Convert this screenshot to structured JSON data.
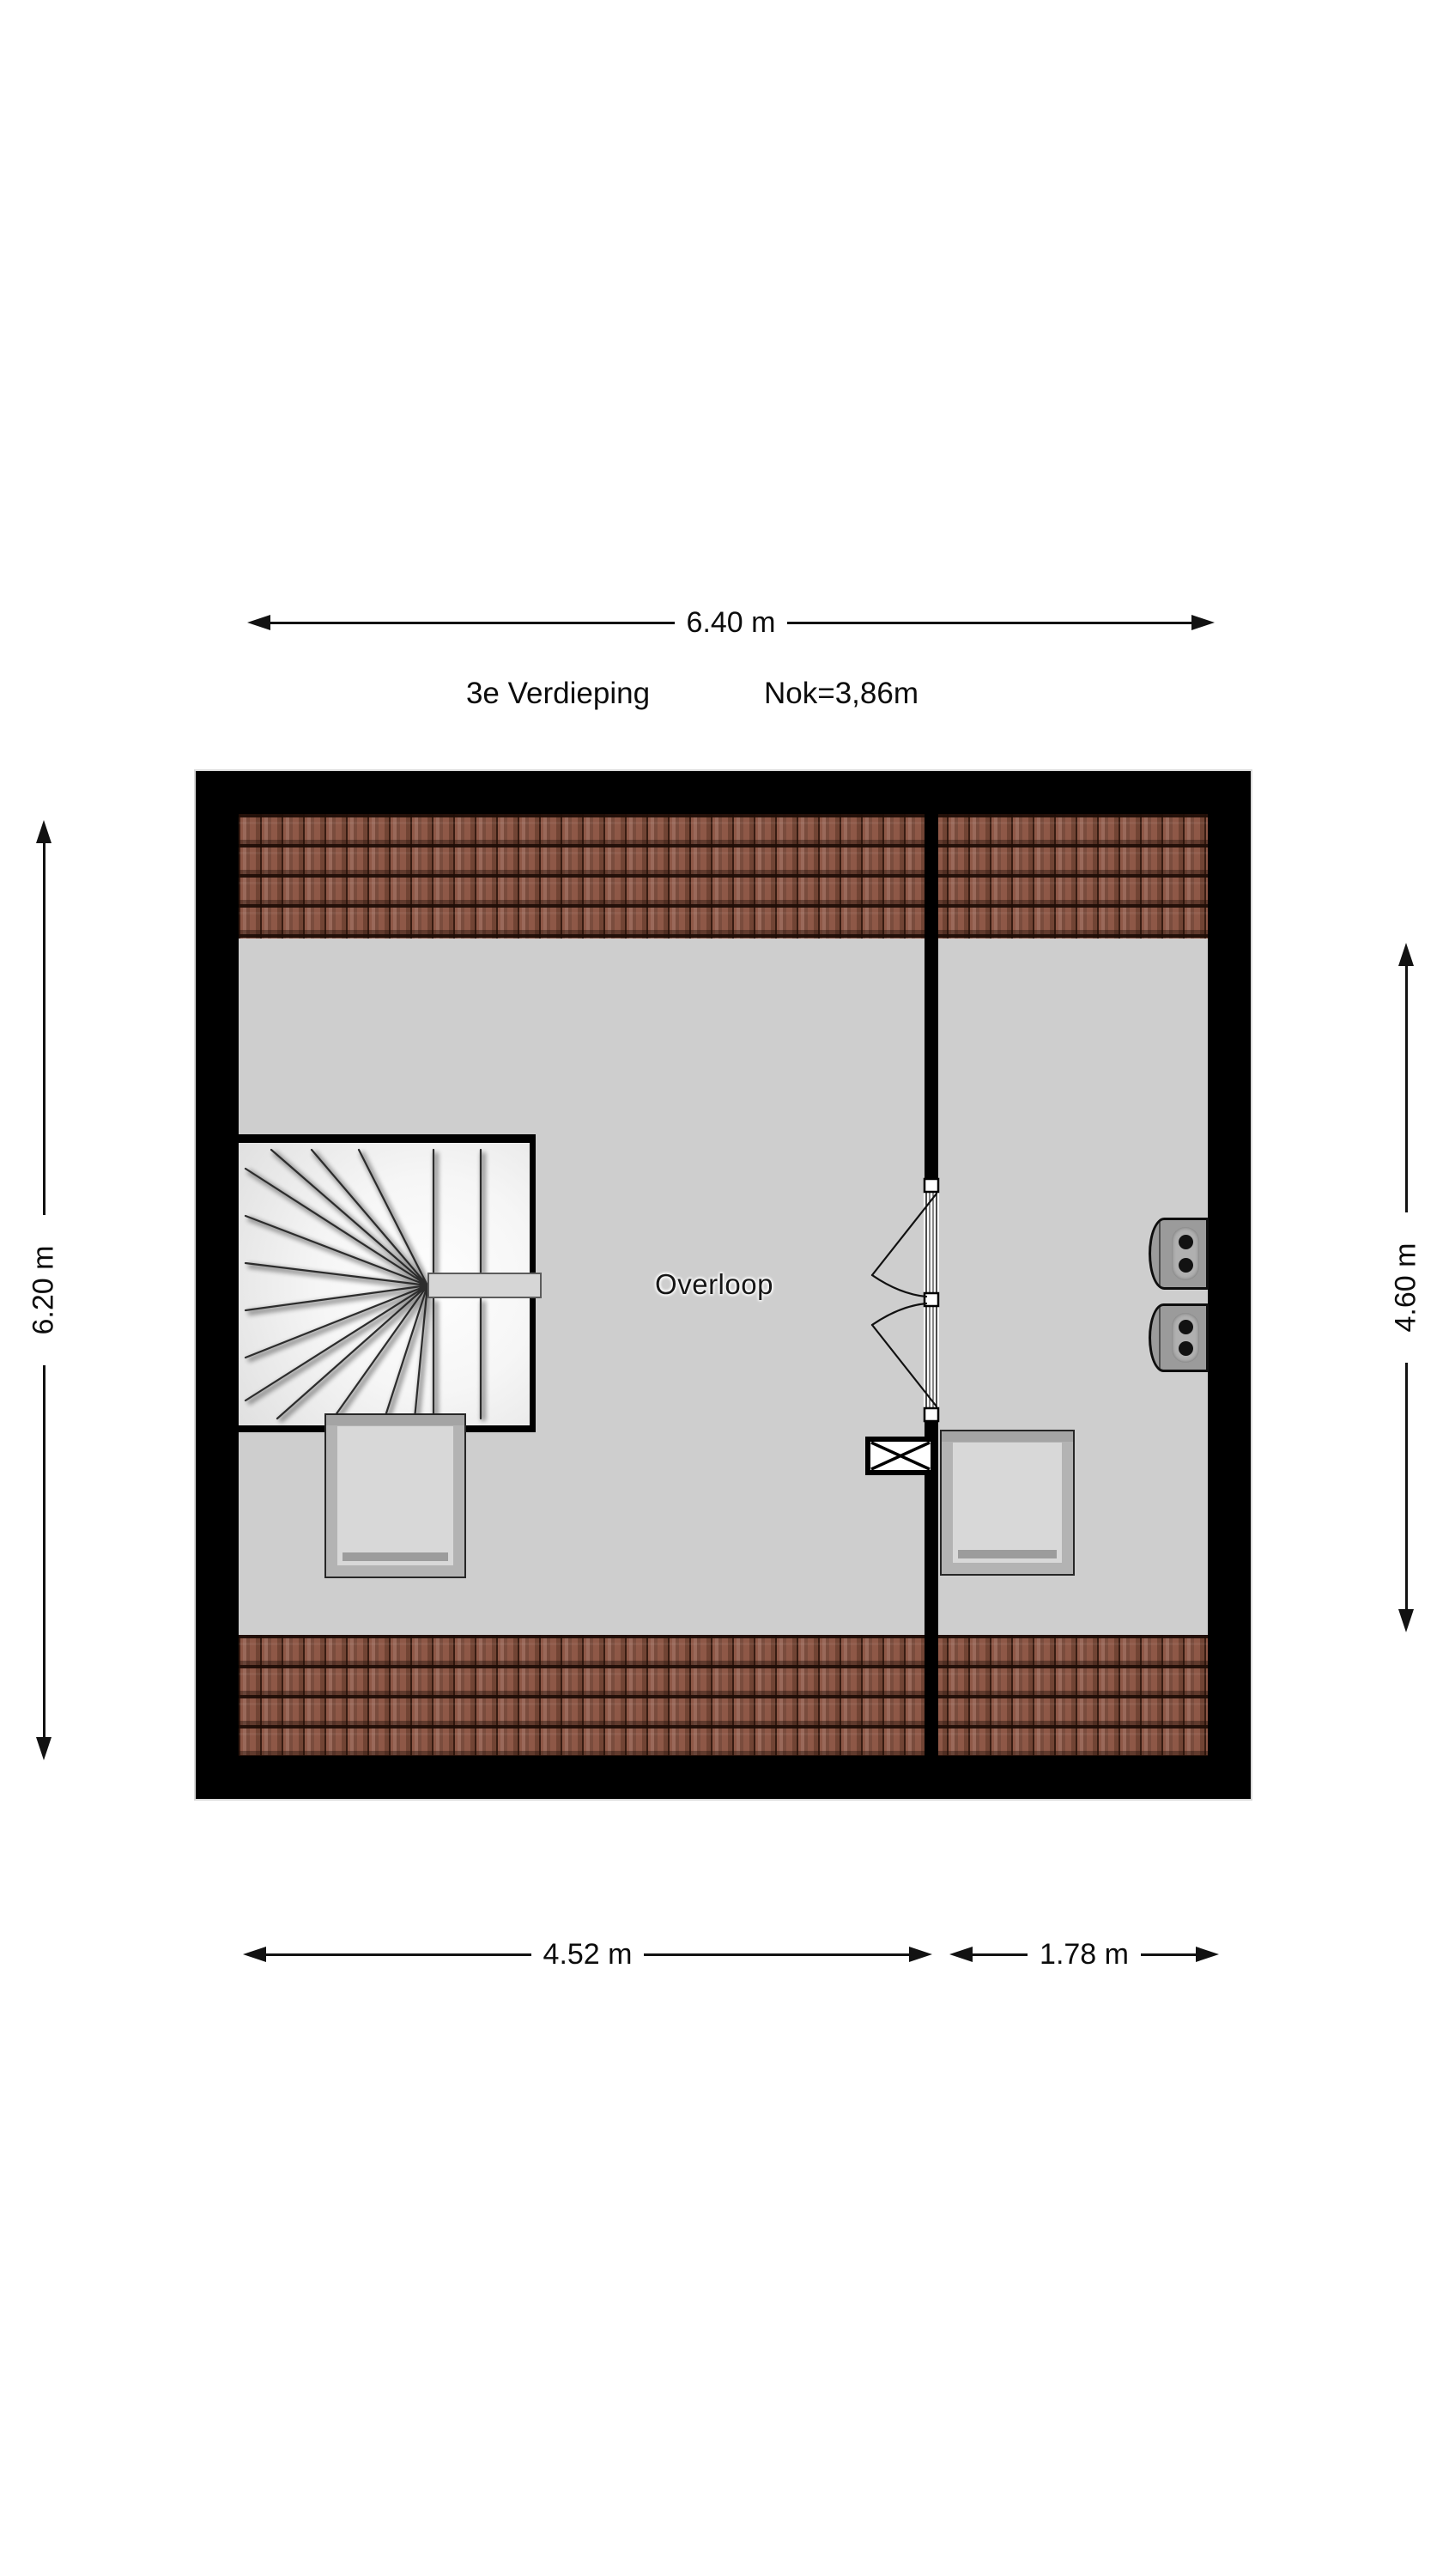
{
  "header": {
    "floor_label": "3e Verdieping",
    "ridge_label": "Nok=3,86m"
  },
  "dims": {
    "top": {
      "label": "6.40 m"
    },
    "left": {
      "label": "6.20 m"
    },
    "right": {
      "label": "4.60 m"
    },
    "bottom_left": {
      "label": "4.52 m"
    },
    "bottom_right": {
      "label": "1.78 m"
    }
  },
  "rooms": {
    "landing_label": "Overloop"
  },
  "colors": {
    "wall": "#000000",
    "floor": "#cecece",
    "roof_tile": "#8e5847",
    "roof_tile_line": "#2e130a",
    "stair_tread": "#f6f6f6",
    "skylight_frame": "#b3b3b3",
    "skylight_glass": "#d8d8d8",
    "unit_gray": "#9b9b9b",
    "text": "#0c0c0c"
  }
}
